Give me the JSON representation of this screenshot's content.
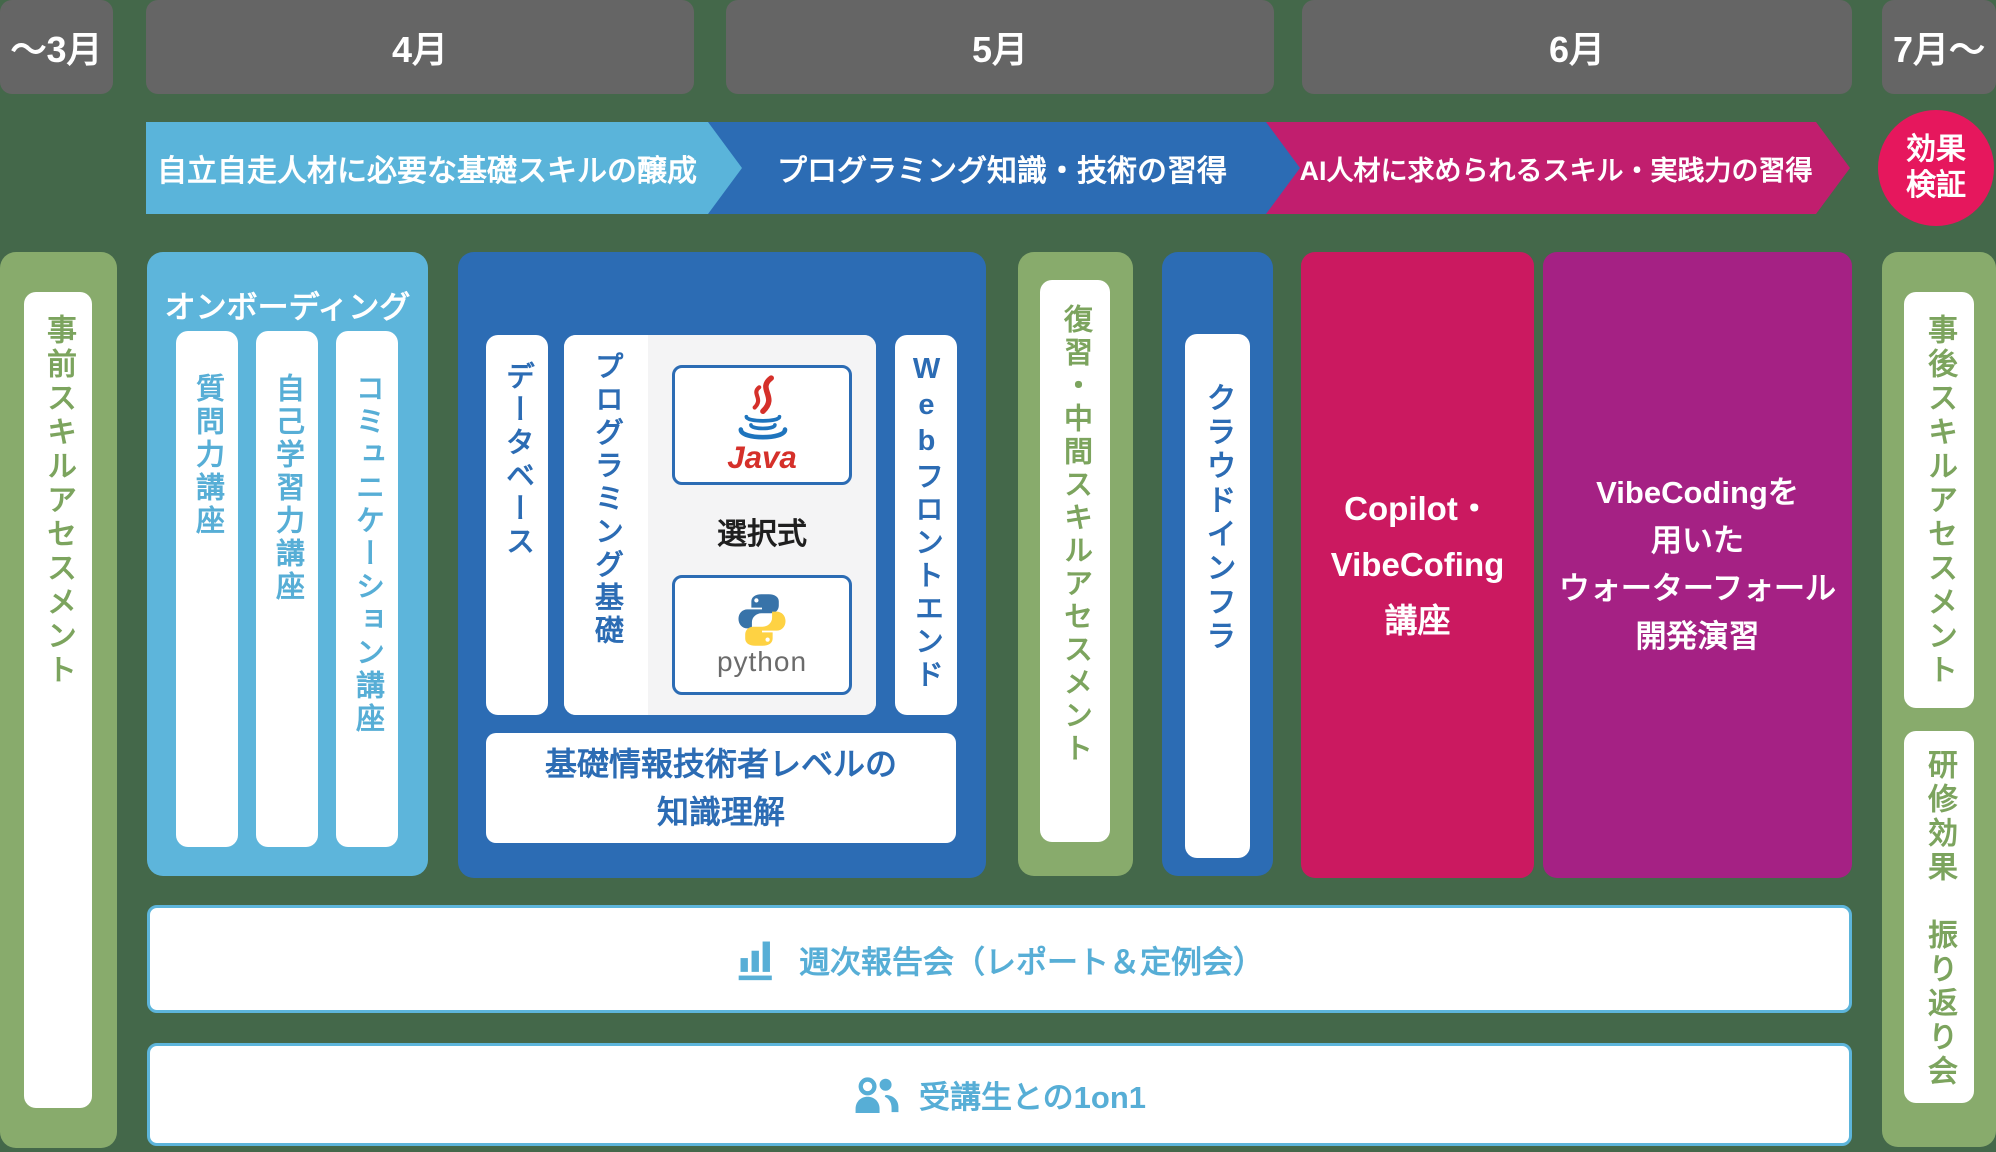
{
  "timeline": {
    "months": [
      "～3月",
      "4月",
      "5月",
      "6月",
      "7月～"
    ]
  },
  "phases": {
    "phase1": "自立自走人材に必要な基礎スキルの醸成",
    "phase2": "プログラミング知識・技術の習得",
    "phase3": "AI人材に求められるスキル・実践力の習得",
    "verify": {
      "line1": "効果",
      "line2": "検証"
    }
  },
  "pre": {
    "label": "事前スキルアセスメント"
  },
  "onboarding": {
    "title": "オンボーディング",
    "courses": [
      "質問力講座",
      "自己学習力講座",
      "コミュニケーション講座"
    ]
  },
  "programming": {
    "database": "データベース",
    "basics": "プログラミング基礎",
    "selective": "選択式",
    "java_label": "Java",
    "python_label": "python",
    "web_latin": "Web",
    "web_kana": "フロントエンド",
    "fe_line1": "基礎情報技術者レベルの",
    "fe_line2": "知識理解"
  },
  "review": {
    "label": "復習・中間スキルアセスメント"
  },
  "cloud": {
    "label": "クラウドインフラ"
  },
  "copilot": {
    "lines": [
      "Copilot・",
      "VibeCofing",
      "講座"
    ]
  },
  "vibecoding": {
    "lines": [
      "VibeCodingを",
      "用いた",
      "ウォーターフォール",
      "開発演習"
    ]
  },
  "post": {
    "label": "事後スキルアセスメント"
  },
  "retrospective": {
    "label": "研修効果　振り返り会"
  },
  "footer": {
    "weekly": "週次報告会（レポート＆定例会）",
    "one_on_one": "受講生との1on1"
  },
  "colors": {
    "background": "#44684a",
    "month_bar": "#656565",
    "light_blue": "#5ab4da",
    "blue": "#2c6cb4",
    "green_column": "#88ab6c",
    "green_text": "#7ca45e",
    "magenta_arrow": "#c11e6e",
    "verify_pink": "#e6175d",
    "copilot_crimson": "#cb1960",
    "vibecoding_purple": "#a52184"
  }
}
